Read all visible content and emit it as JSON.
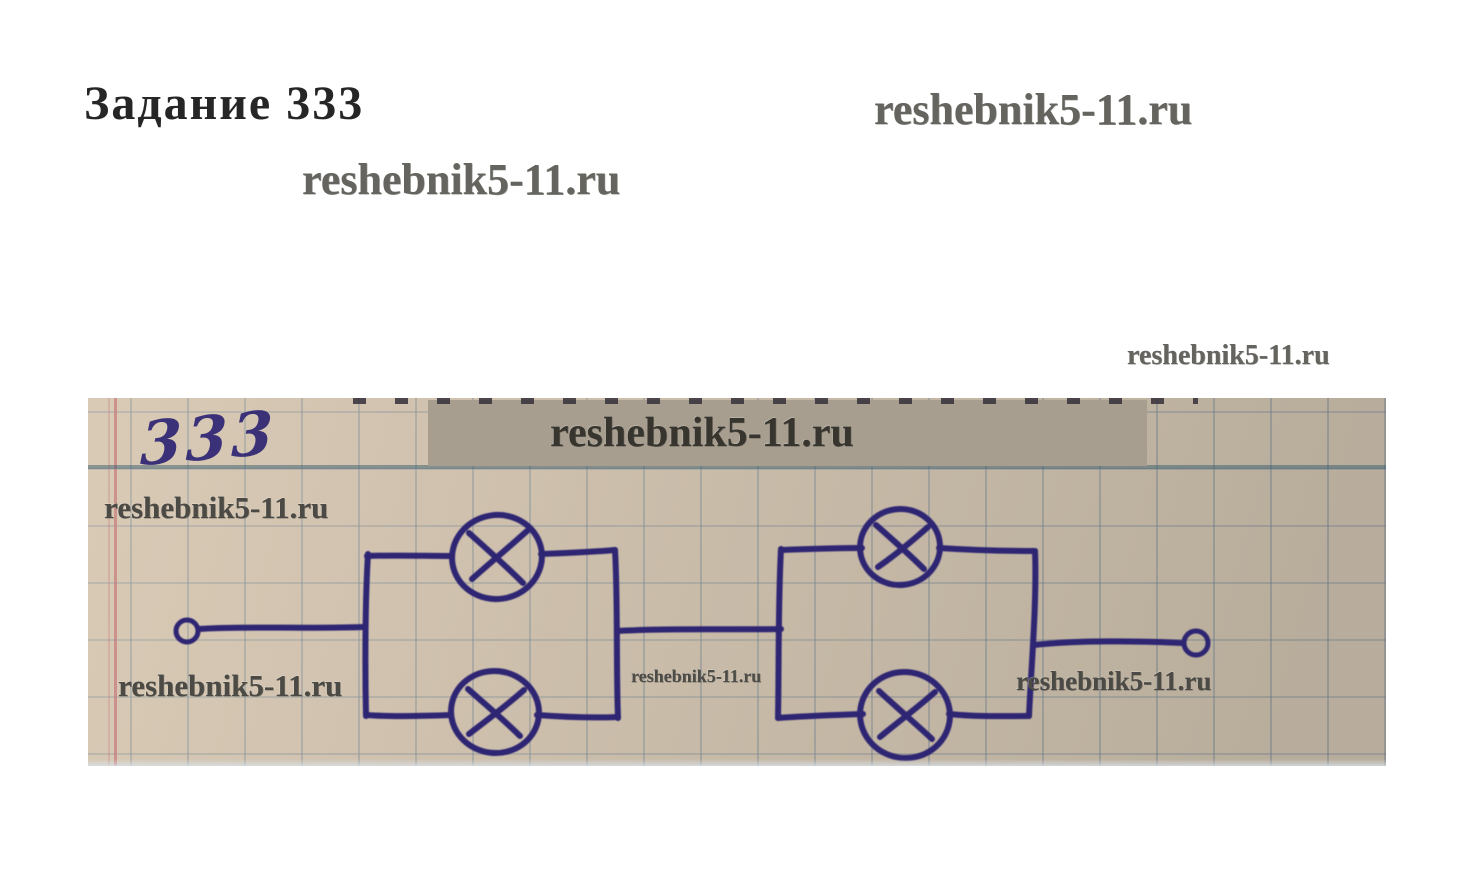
{
  "page_title": "Задание 333",
  "watermark": "reshebnik5-11.ru",
  "photo": {
    "handwritten_label": "333"
  },
  "colors": {
    "ink": "#2e2573",
    "paper": "#c9bca8",
    "banner": "#a79e90",
    "margin_red": "#c87f7f",
    "watermark_gray": "#66645e"
  }
}
